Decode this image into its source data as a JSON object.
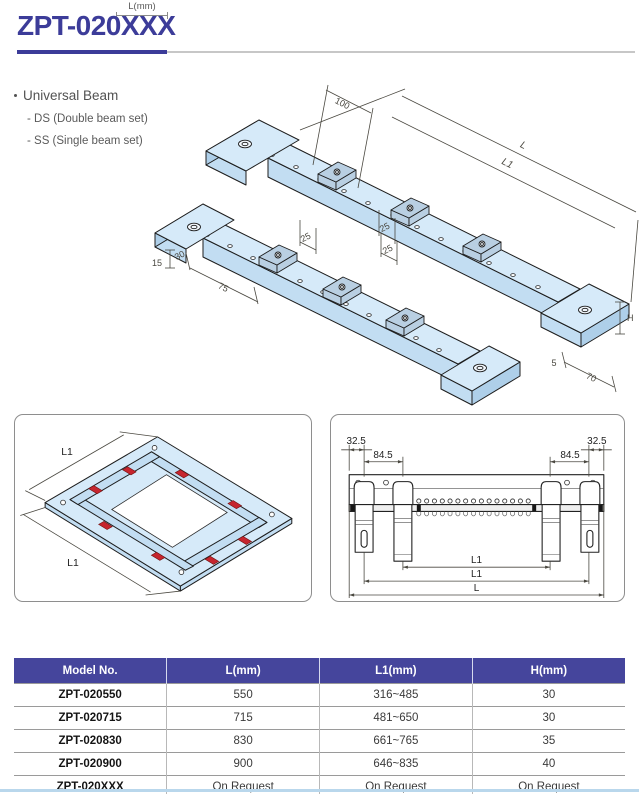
{
  "colors": {
    "accent": "#3c3c99",
    "table_header_bg": "#45459c",
    "drawing_fill": "#d6eaf9",
    "drawing_fill_dark": "#c2ddf2",
    "drawing_fill_darker": "#aecfe9",
    "clamp_fill": "#b9cfe2",
    "red": "#c6252e",
    "footer_line": "#b9d7ec",
    "dim_text": "#4a4840"
  },
  "header": {
    "title": "ZPT-020XXX",
    "annotation": "L(mm)"
  },
  "features": {
    "heading": "Universal Beam",
    "items": [
      "- DS (Double beam set)",
      "- SS (Single beam set)"
    ]
  },
  "main_drawing": {
    "dims": {
      "d100": "100",
      "l": "L",
      "l1": "L1",
      "d25_1": "25",
      "d25_2": "25",
      "d25_3": "25",
      "d15": "15",
      "d30": "30",
      "d75": "75",
      "h": "H",
      "d5": "5",
      "d70": "70"
    }
  },
  "left_box": {
    "l1_top": "L1",
    "l1_bottom": "L1"
  },
  "right_box": {
    "d325_left": "32.5",
    "d845_left": "84.5",
    "d845_right": "84.5",
    "d325_right": "32.5",
    "l1_inner": "L1",
    "l1_outer": "L1",
    "l": "L"
  },
  "table": {
    "headers": [
      "Model No.",
      "L(mm)",
      "L1(mm)",
      "H(mm)"
    ],
    "rows": [
      {
        "model": "ZPT-020550",
        "l": "550",
        "l1": "316~485",
        "h": "30"
      },
      {
        "model": "ZPT-020715",
        "l": "715",
        "l1": "481~650",
        "h": "30"
      },
      {
        "model": "ZPT-020830",
        "l": "830",
        "l1": "661~765",
        "h": "35"
      },
      {
        "model": "ZPT-020900",
        "l": "900",
        "l1": "646~835",
        "h": "40"
      },
      {
        "model": "ZPT-020XXX",
        "l": "On Request",
        "l1": "On Request",
        "h": "On Request"
      }
    ]
  }
}
